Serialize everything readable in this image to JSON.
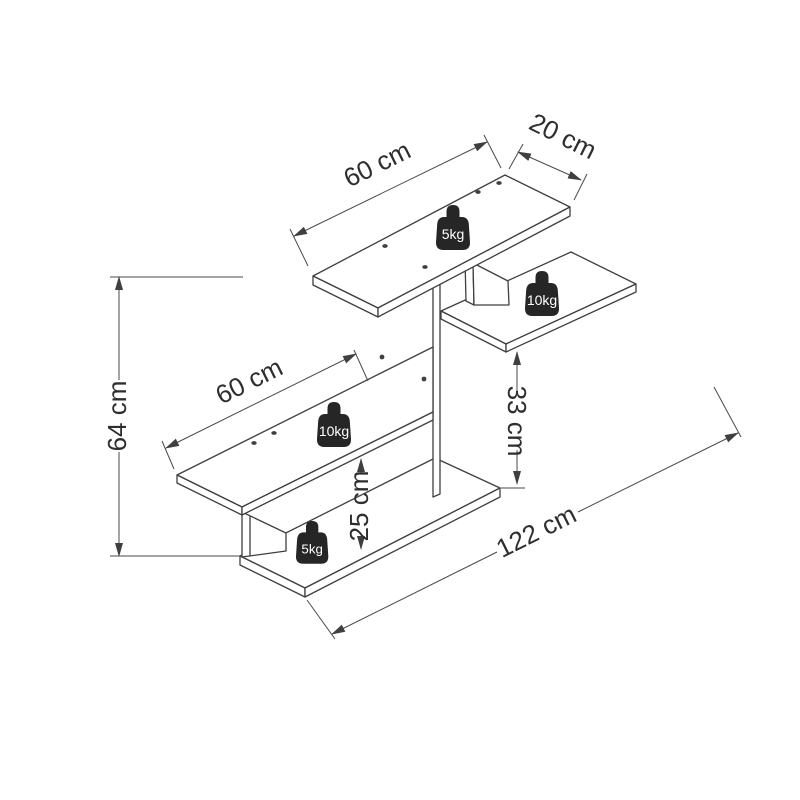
{
  "diagram": {
    "type": "furniture-dimension-drawing",
    "subject": "wall shelf isometric drawing with dimensions and load ratings",
    "dimensions": {
      "top_shelf_width": "60 cm",
      "top_shelf_depth": "20 cm",
      "total_height": "64 cm",
      "middle_shelf_width": "60 cm",
      "right_shelf_clearance": "33 cm",
      "bottom_clearance": "25 cm",
      "total_width": "122 cm"
    },
    "load_ratings": {
      "top_shelf": "5kg",
      "right_shelf": "10kg",
      "middle_shelf": "10kg",
      "bottom_shelf": "5kg"
    },
    "colors": {
      "line": "#3f3f3f",
      "dim_line": "#4a4a4a",
      "label_text": "#2e2e2e",
      "weight_fill": "#262626",
      "weight_text": "#ffffff",
      "background": "#ffffff"
    }
  }
}
